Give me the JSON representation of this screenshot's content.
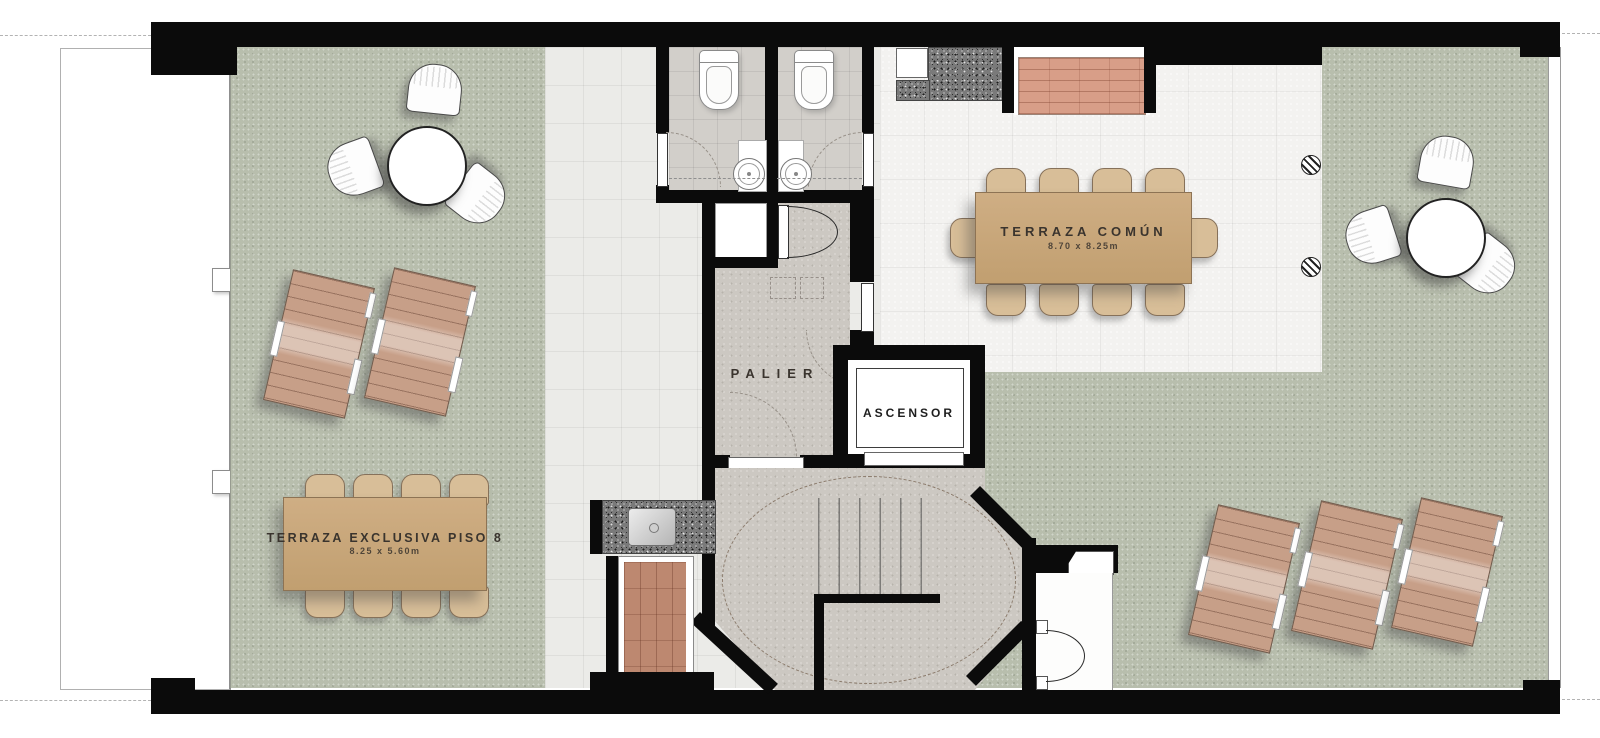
{
  "plan": {
    "type": "architectural-floor-plan",
    "labels": {
      "terraza_comun": {
        "title": "TERRAZA COMÚN",
        "dims": "8.70 x 8.25m"
      },
      "terraza_exclusiva": {
        "title": "TERRAZA EXCLUSIVA PISO 8",
        "dims": "8.25 x 5.60m"
      },
      "palier": "PALIER",
      "ascensor": "ASCENSOR"
    },
    "colors": {
      "wall": "#0b0b0b",
      "green": "#b8bead",
      "tile_pale": "#ebebe8",
      "tile_white": "#f3f2f0",
      "bath_floor": "#d2cfca",
      "concrete": "#ccc8c2",
      "wood": "#c8a67c",
      "wood_chair": "#d8be98",
      "lounger": "#c79f88",
      "brick": "#d89e88",
      "terracotta": "#bd8870",
      "granite_dark": "#4a4a4a",
      "label_ink": "#3a342e"
    }
  }
}
